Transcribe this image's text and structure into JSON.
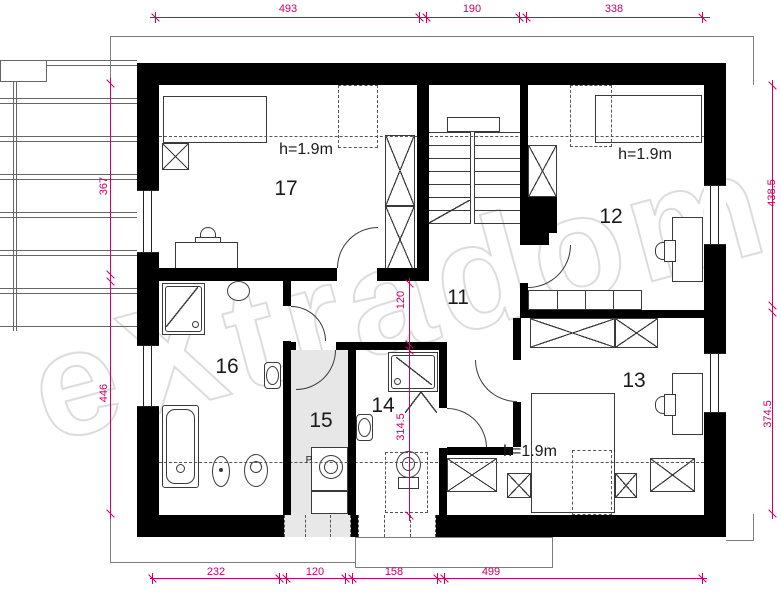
{
  "watermark": "eXtradom",
  "rooms": {
    "r11": {
      "number": "11"
    },
    "r12": {
      "number": "12",
      "height_note": "h=1.9m"
    },
    "r13": {
      "number": "13",
      "height_note": "h=1.9m"
    },
    "r14": {
      "number": "14"
    },
    "r15": {
      "number": "15",
      "appliance_label": "P"
    },
    "r16": {
      "number": "16"
    },
    "r17": {
      "number": "17",
      "height_note": "h=1.9m"
    }
  },
  "dimensions": {
    "top": [
      "493",
      "190",
      "338"
    ],
    "left": [
      "367",
      "446"
    ],
    "right": [
      "438.5",
      "374.5"
    ],
    "bottom": [
      "232",
      "120",
      "158",
      "499"
    ],
    "interior": [
      "120",
      "314.5"
    ]
  },
  "colors": {
    "dimension": "#cc0066",
    "wall": "#000000",
    "furniture_line": "#3a3a3a",
    "room15_floor": "#e7e7e7",
    "watermark_outline": "#dcdcdc"
  }
}
